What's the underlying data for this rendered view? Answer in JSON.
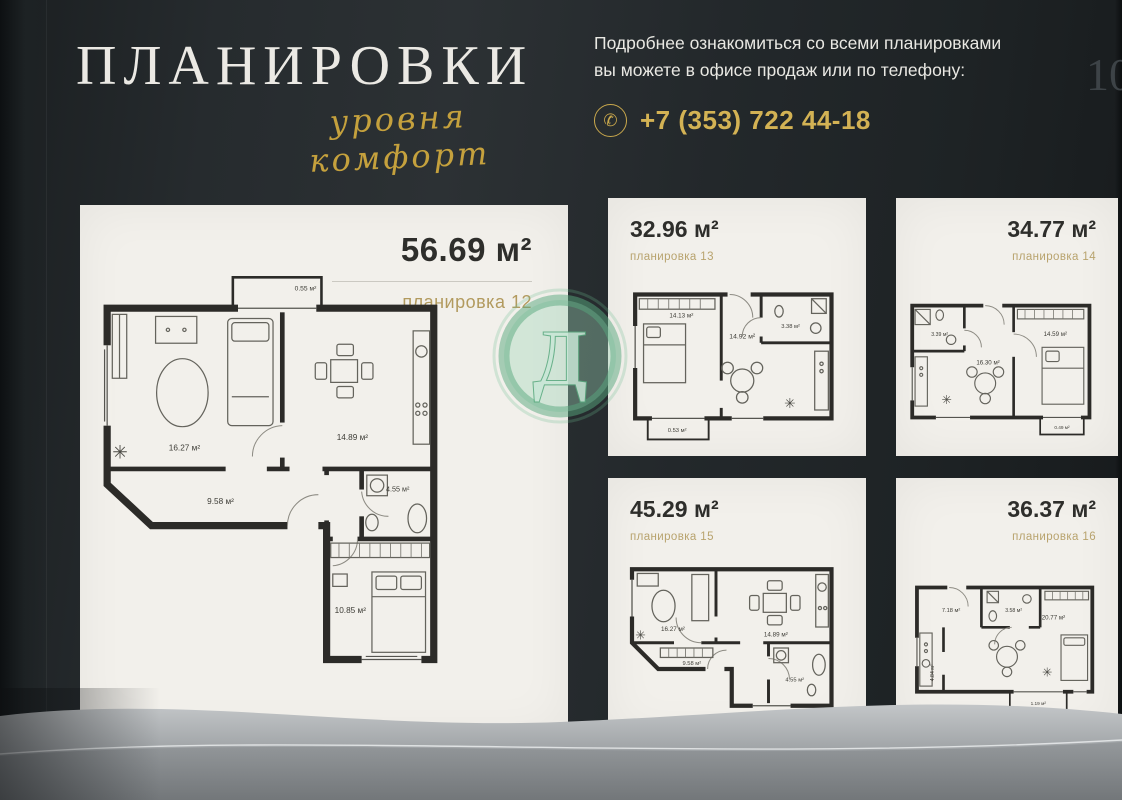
{
  "header": {
    "title": "ПЛАНИРОВКИ",
    "subtitle": "уровня комфорт",
    "info_line1": "Подробнее ознакомиться со всеми планировками",
    "info_line2": "вы можете в офисе продаж или по телефону:",
    "phone": "+7 (353) 722 44-18",
    "page_number": "10"
  },
  "icons": {
    "phone": "✆",
    "plant": "✳"
  },
  "watermark": {
    "letter": "Д"
  },
  "colors": {
    "background": "#23282b",
    "card": "#f2f0eb",
    "gold": "#c9a84c",
    "plan_name_gold": "#b29a5e",
    "watermark_green": "#57a87d",
    "walls": "#2c2b28",
    "silver_band": "#a9adb0"
  },
  "main_plan": {
    "area": "56.69 м²",
    "name": "планировка 12",
    "rooms": {
      "living": "16.27 м²",
      "kitchen": "14.89 м²",
      "hall": "9.58 м²",
      "bath": "4.55 м²",
      "bedroom": "10.85 м²",
      "balcony": "0.55 м²"
    }
  },
  "plans": [
    {
      "area": "32.96 м²",
      "name": "планировка 13",
      "rooms": {
        "bedroom": "14.13 м²",
        "living": "14.92 м²",
        "bath": "3.38 м²",
        "balcony": "0.53 м²"
      }
    },
    {
      "area": "34.77 м²",
      "name": "планировка 14",
      "rooms": {
        "bath": "3.39 м²",
        "living": "16.30 м²",
        "bedroom": "14.59 м²",
        "balcony": "0.49 м²"
      }
    },
    {
      "area": "45.29 м²",
      "name": "планировка 15",
      "rooms": {
        "living": "16.27 м²",
        "kitchen": "14.89 м²",
        "hall": "9.58 м²",
        "bath": "4.55 м²"
      }
    },
    {
      "area": "36.37 м²",
      "name": "планировка 16",
      "rooms": {
        "hall": "7.18 м²",
        "bath": "3.58 м²",
        "living": "20.77 м²",
        "kitchen": "4.84 м²",
        "balcony": "1.19 м²"
      }
    }
  ]
}
